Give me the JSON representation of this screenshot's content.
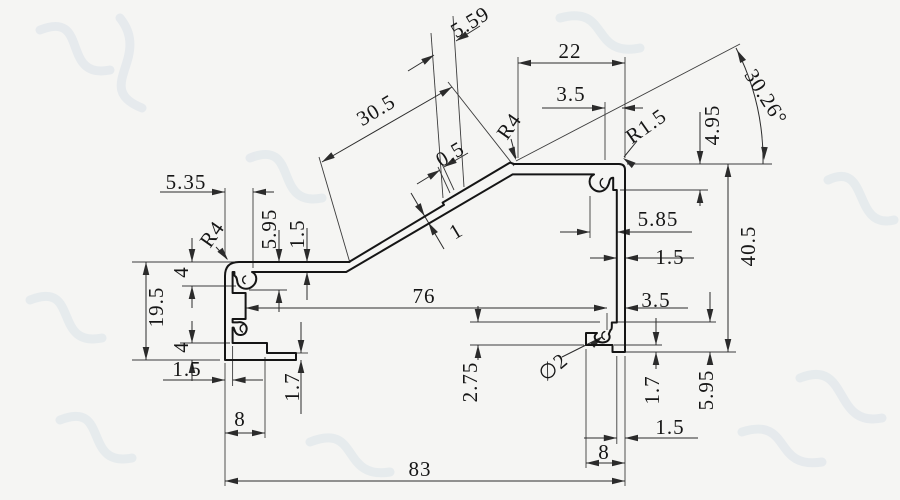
{
  "meta": {
    "type": "technical-drawing",
    "subject": "aluminum extrusion profile cross-section with dimensions",
    "canvas": {
      "width": 900,
      "height": 500
    },
    "colors": {
      "background": "#f5f5f3",
      "profile_stroke": "#151515",
      "dimension_stroke": "#2b2b2b",
      "extension_stroke": "#3c3c3c",
      "text_color": "#111111",
      "watermark": "#c5d3e2"
    },
    "font_size": 21,
    "profile_stroke_width": 2.0,
    "dim_stroke_width": 1.0,
    "ext_stroke_width": 0.9
  },
  "watermark": {
    "opacity": 0.3,
    "stroke_width": 9,
    "paths": [
      "M 40,30 C 90,10 60,80 110,70",
      "M 120,18 C 152,58 92,88 142,108",
      "M 560,18 C 610,4 590,58 640,48",
      "M 250,158 C 300,138 272,208 322,198",
      "M 30,300 C 80,280 52,348 102,338",
      "M 60,420 C 110,400 82,468 132,458",
      "M 800,378 C 850,358 832,428 882,418",
      "M 742,432 C 792,416 772,470 822,462",
      "M 310,442 C 360,422 340,480 390,472",
      "M 828,180 C 870,160 852,230 894,220"
    ]
  },
  "profile": {
    "main_path": "M 239,262 L 349,262 L 444,204.9 L 442.6,202.6 L 510,162.6 L 514,164 L 619,164 Q 625,164 625,170 L 625,352 L 612.5,352 L 612.5,345 L 586,345 L 586,333 L 597,333 C 592.8,336.6 594.6,341.8 601.5,342.4 C 607.6,342.9 611.3,338.9 608.8,334 L 610.5,330 C 612,330 611.9,326 611.8,322.5 L 616.8,322.5 L 616.8,190 L 613.2,190 L 613.2,177.8 Q 610.8,177.6 609.6,180.4 C 607.8,191.4 599.4,193.6 593.6,189.4 C 588,185.2 588.4,176.8 594,174.4 L 512.6,174.4 L 346.2,272 L 252,272 C 257.4,274.6 257.8,281.8 252.4,286.4 C 247,290.9 239.2,288.4 237.6,283 C 236.8,280.2 237.4,277 234.4,275.6 L 234.4,272 L 232.6,272 L 232.6,293 L 245.6,293 L 245.6,319 L 232.6,319 L 232.6,322.4 L 237.4,322.4 C 243.4,321.2 247.8,325.6 246.4,330.6 C 244.9,336 237.4,336.6 235,331.4 L 233.6,327.6 L 232.6,327.6 L 232.6,343 L 267,343 L 267,353 L 296,353 L 296,360 L 225,360 L 225,276 Q 225,262 239,262 Z",
    "detail_curls": [
      "M 604,188 C 599.6,186.4 599,181 602.6,178.6",
      "M 604.4,339.4 C 600.8,337.6 601.2,332.8 604.8,331.6",
      "M 245,283.6 C 241.6,281.8 242,277.2 245.6,276",
      "M 242.4,332 C 239.2,330.2 239.6,325.6 243.2,324.6"
    ]
  },
  "dims": {
    "extension_lines": [
      [
        132,
        262,
        236,
        262
      ],
      [
        132,
        360,
        220,
        360
      ],
      [
        182,
        286,
        236,
        286
      ],
      [
        180,
        343,
        230,
        343
      ],
      [
        225,
        188,
        225,
        257
      ],
      [
        253,
        188,
        253,
        268
      ],
      [
        249,
        290,
        287,
        290
      ],
      [
        225,
        363,
        225,
        486
      ],
      [
        232.6,
        346,
        232.6,
        386
      ],
      [
        265,
        357,
        265,
        438
      ],
      [
        296,
        353,
        308,
        353
      ],
      [
        518,
        57,
        518,
        158
      ],
      [
        625,
        57,
        625,
        158
      ],
      [
        605,
        102,
        605,
        160
      ],
      [
        627,
        164,
        772,
        164
      ],
      [
        620,
        190,
        708,
        190
      ],
      [
        590,
        196,
        590,
        238
      ],
      [
        607,
        313,
        607,
        330
      ],
      [
        470,
        322,
        600,
        322
      ],
      [
        612,
        322,
        716,
        322
      ],
      [
        470,
        345,
        584,
        345
      ],
      [
        614,
        345,
        662,
        345
      ],
      [
        626,
        352,
        736,
        352
      ],
      [
        616.8,
        356,
        616.8,
        444
      ],
      [
        625,
        356,
        625,
        486
      ],
      [
        586,
        349,
        586,
        468
      ],
      [
        443,
        198,
        431,
        33
      ],
      [
        464,
        187,
        453,
        16
      ],
      [
        350,
        263,
        319,
        157
      ],
      [
        514,
        166,
        448,
        82
      ],
      [
        450,
        193,
        438,
        167
      ],
      [
        454,
        190,
        442,
        164
      ],
      [
        516,
        161,
        740,
        44
      ]
    ],
    "dimension_lines": [
      [
        146,
        262,
        146,
        360
      ],
      [
        192,
        238,
        192,
        262
      ],
      [
        192,
        286,
        192,
        308
      ],
      [
        192,
        321,
        192,
        343
      ],
      [
        192,
        360,
        192,
        381
      ],
      [
        279,
        230,
        279,
        262
      ],
      [
        279,
        290,
        279,
        312
      ],
      [
        307,
        228,
        307,
        262
      ],
      [
        307,
        272,
        307,
        300
      ],
      [
        160,
        192,
        225,
        192
      ],
      [
        253,
        192,
        274,
        192
      ],
      [
        163,
        380,
        225,
        380
      ],
      [
        232.6,
        380,
        263,
        380
      ],
      [
        225,
        433,
        265,
        433
      ],
      [
        225,
        481,
        625,
        481
      ],
      [
        245.6,
        308,
        607,
        308
      ],
      [
        625,
        308,
        688,
        308
      ],
      [
        301,
        322,
        301,
        353
      ],
      [
        301,
        360,
        301,
        414
      ],
      [
        518,
        63,
        625,
        63
      ],
      [
        542,
        108,
        605,
        108
      ],
      [
        622,
        108,
        643,
        108
      ],
      [
        408,
        71,
        434,
        55
      ],
      [
        456,
        41,
        480,
        26
      ],
      [
        322,
        162,
        452,
        87
      ],
      [
        417,
        184,
        440,
        170
      ],
      [
        444,
        167,
        468,
        153
      ],
      [
        411,
        193,
        444,
        249
      ],
      [
        700,
        112,
        700,
        164
      ],
      [
        700,
        190,
        700,
        206
      ],
      [
        728,
        164,
        728,
        352
      ],
      [
        560,
        232,
        590,
        232
      ],
      [
        616.8,
        232,
        692,
        232
      ],
      [
        590,
        258,
        616.8,
        258
      ],
      [
        625,
        258,
        694,
        258
      ],
      [
        478,
        306,
        478,
        322
      ],
      [
        478,
        345,
        478,
        360
      ],
      [
        710,
        292,
        710,
        322
      ],
      [
        710,
        352,
        710,
        363
      ],
      [
        656,
        318,
        656,
        345
      ],
      [
        656,
        352,
        656,
        369
      ],
      [
        584,
        438,
        616.8,
        438
      ],
      [
        625,
        438,
        698,
        438
      ],
      [
        586,
        463,
        625,
        463
      ]
    ],
    "leader_lines": [
      [
        562,
        357,
        602,
        337
      ],
      [
        511,
        139,
        516,
        158
      ],
      [
        216,
        247,
        227,
        259
      ],
      [
        637,
        141,
        624,
        157
      ]
    ],
    "angle_arc": "M 736,48 A 246,246 0 0 1 763,164",
    "arrows": [
      [
        146,
        262,
        -90
      ],
      [
        146,
        360,
        90
      ],
      [
        192,
        262,
        90
      ],
      [
        192,
        286,
        -90
      ],
      [
        192,
        343,
        90
      ],
      [
        192,
        360,
        -90
      ],
      [
        279,
        262,
        90
      ],
      [
        279,
        290,
        -90
      ],
      [
        307,
        262,
        90
      ],
      [
        307,
        272,
        -90
      ],
      [
        225,
        192,
        0
      ],
      [
        253,
        192,
        180
      ],
      [
        225,
        380,
        0
      ],
      [
        232.6,
        380,
        180
      ],
      [
        225,
        433,
        180
      ],
      [
        265,
        433,
        0
      ],
      [
        225,
        481,
        180
      ],
      [
        625,
        481,
        0
      ],
      [
        245.6,
        308,
        180
      ],
      [
        607,
        308,
        0
      ],
      [
        607,
        308,
        0
      ],
      [
        625,
        308,
        180
      ],
      [
        301,
        353,
        90
      ],
      [
        301,
        360,
        -90
      ],
      [
        518,
        63,
        180
      ],
      [
        625,
        63,
        0
      ],
      [
        605,
        108,
        0
      ],
      [
        622,
        108,
        180
      ],
      [
        434,
        55,
        -32
      ],
      [
        456,
        41,
        148
      ],
      [
        322,
        162,
        148
      ],
      [
        452,
        87,
        -32
      ],
      [
        440,
        170,
        -32
      ],
      [
        444,
        167,
        148
      ],
      [
        424.6,
        216,
        59
      ],
      [
        428.4,
        222.6,
        -121
      ],
      [
        700,
        164,
        90
      ],
      [
        700,
        190,
        -90
      ],
      [
        728,
        164,
        -90
      ],
      [
        728,
        352,
        90
      ],
      [
        590,
        232,
        0
      ],
      [
        616.8,
        232,
        180
      ],
      [
        616.8,
        258,
        0
      ],
      [
        625,
        258,
        180
      ],
      [
        478,
        322,
        90
      ],
      [
        478,
        345,
        -90
      ],
      [
        710,
        322,
        90
      ],
      [
        710,
        352,
        -90
      ],
      [
        656,
        345,
        90
      ],
      [
        656,
        352,
        -90
      ],
      [
        616.8,
        438,
        0
      ],
      [
        625,
        438,
        180
      ],
      [
        586,
        463,
        180
      ],
      [
        625,
        463,
        0
      ],
      [
        602,
        337,
        -40
      ],
      [
        516,
        160,
        70
      ],
      [
        228,
        260,
        52
      ],
      [
        623,
        158,
        215
      ],
      [
        737,
        50,
        -118
      ],
      [
        764,
        160,
        92
      ]
    ],
    "labels": [
      {
        "t": "5.35",
        "x": 186,
        "y": 182,
        "r": 0
      },
      {
        "t": "R4",
        "x": 212,
        "y": 234,
        "r": -55
      },
      {
        "t": "5.95",
        "x": 269,
        "y": 229,
        "r": -90
      },
      {
        "t": "1.5",
        "x": 297,
        "y": 234,
        "r": -90
      },
      {
        "t": "4",
        "x": 181,
        "y": 272,
        "r": -90
      },
      {
        "t": "19.5",
        "x": 156,
        "y": 307,
        "r": -90
      },
      {
        "t": "4",
        "x": 181,
        "y": 347,
        "r": -90
      },
      {
        "t": "1.5",
        "x": 187,
        "y": 369,
        "r": 0
      },
      {
        "t": "1.7",
        "x": 292,
        "y": 387,
        "r": -90
      },
      {
        "t": "8",
        "x": 240,
        "y": 419,
        "r": 0
      },
      {
        "t": "76",
        "x": 424,
        "y": 296,
        "r": 0
      },
      {
        "t": "83",
        "x": 420,
        "y": 469,
        "r": 0
      },
      {
        "t": "30.5",
        "x": 376,
        "y": 110,
        "r": -31
      },
      {
        "t": "5.59",
        "x": 470,
        "y": 22,
        "r": -31
      },
      {
        "t": "0.5",
        "x": 450,
        "y": 154,
        "r": -31
      },
      {
        "t": "1",
        "x": 456,
        "y": 231,
        "r": -31
      },
      {
        "t": "R4",
        "x": 509,
        "y": 126,
        "r": -55
      },
      {
        "t": "22",
        "x": 570,
        "y": 51,
        "r": 0
      },
      {
        "t": "3.5",
        "x": 571,
        "y": 94,
        "r": 0
      },
      {
        "t": "R1.5",
        "x": 646,
        "y": 126,
        "r": -35
      },
      {
        "t": "4.95",
        "x": 712,
        "y": 125,
        "r": -90
      },
      {
        "t": "30.26°",
        "x": 766,
        "y": 97,
        "r": 58
      },
      {
        "t": "5.85",
        "x": 658,
        "y": 219,
        "r": 0
      },
      {
        "t": "1.5",
        "x": 670,
        "y": 257,
        "r": 0
      },
      {
        "t": "40.5",
        "x": 748,
        "y": 246,
        "r": -90
      },
      {
        "t": "3.5",
        "x": 656,
        "y": 300,
        "r": 0
      },
      {
        "t": "∅2",
        "x": 553,
        "y": 367,
        "r": -40
      },
      {
        "t": "2.75",
        "x": 470,
        "y": 382,
        "r": -90
      },
      {
        "t": "1.7",
        "x": 652,
        "y": 390,
        "r": -90
      },
      {
        "t": "5.95",
        "x": 706,
        "y": 390,
        "r": -90
      },
      {
        "t": "1.5",
        "x": 670,
        "y": 427,
        "r": 0
      },
      {
        "t": "8",
        "x": 604,
        "y": 452,
        "r": 0
      }
    ]
  }
}
